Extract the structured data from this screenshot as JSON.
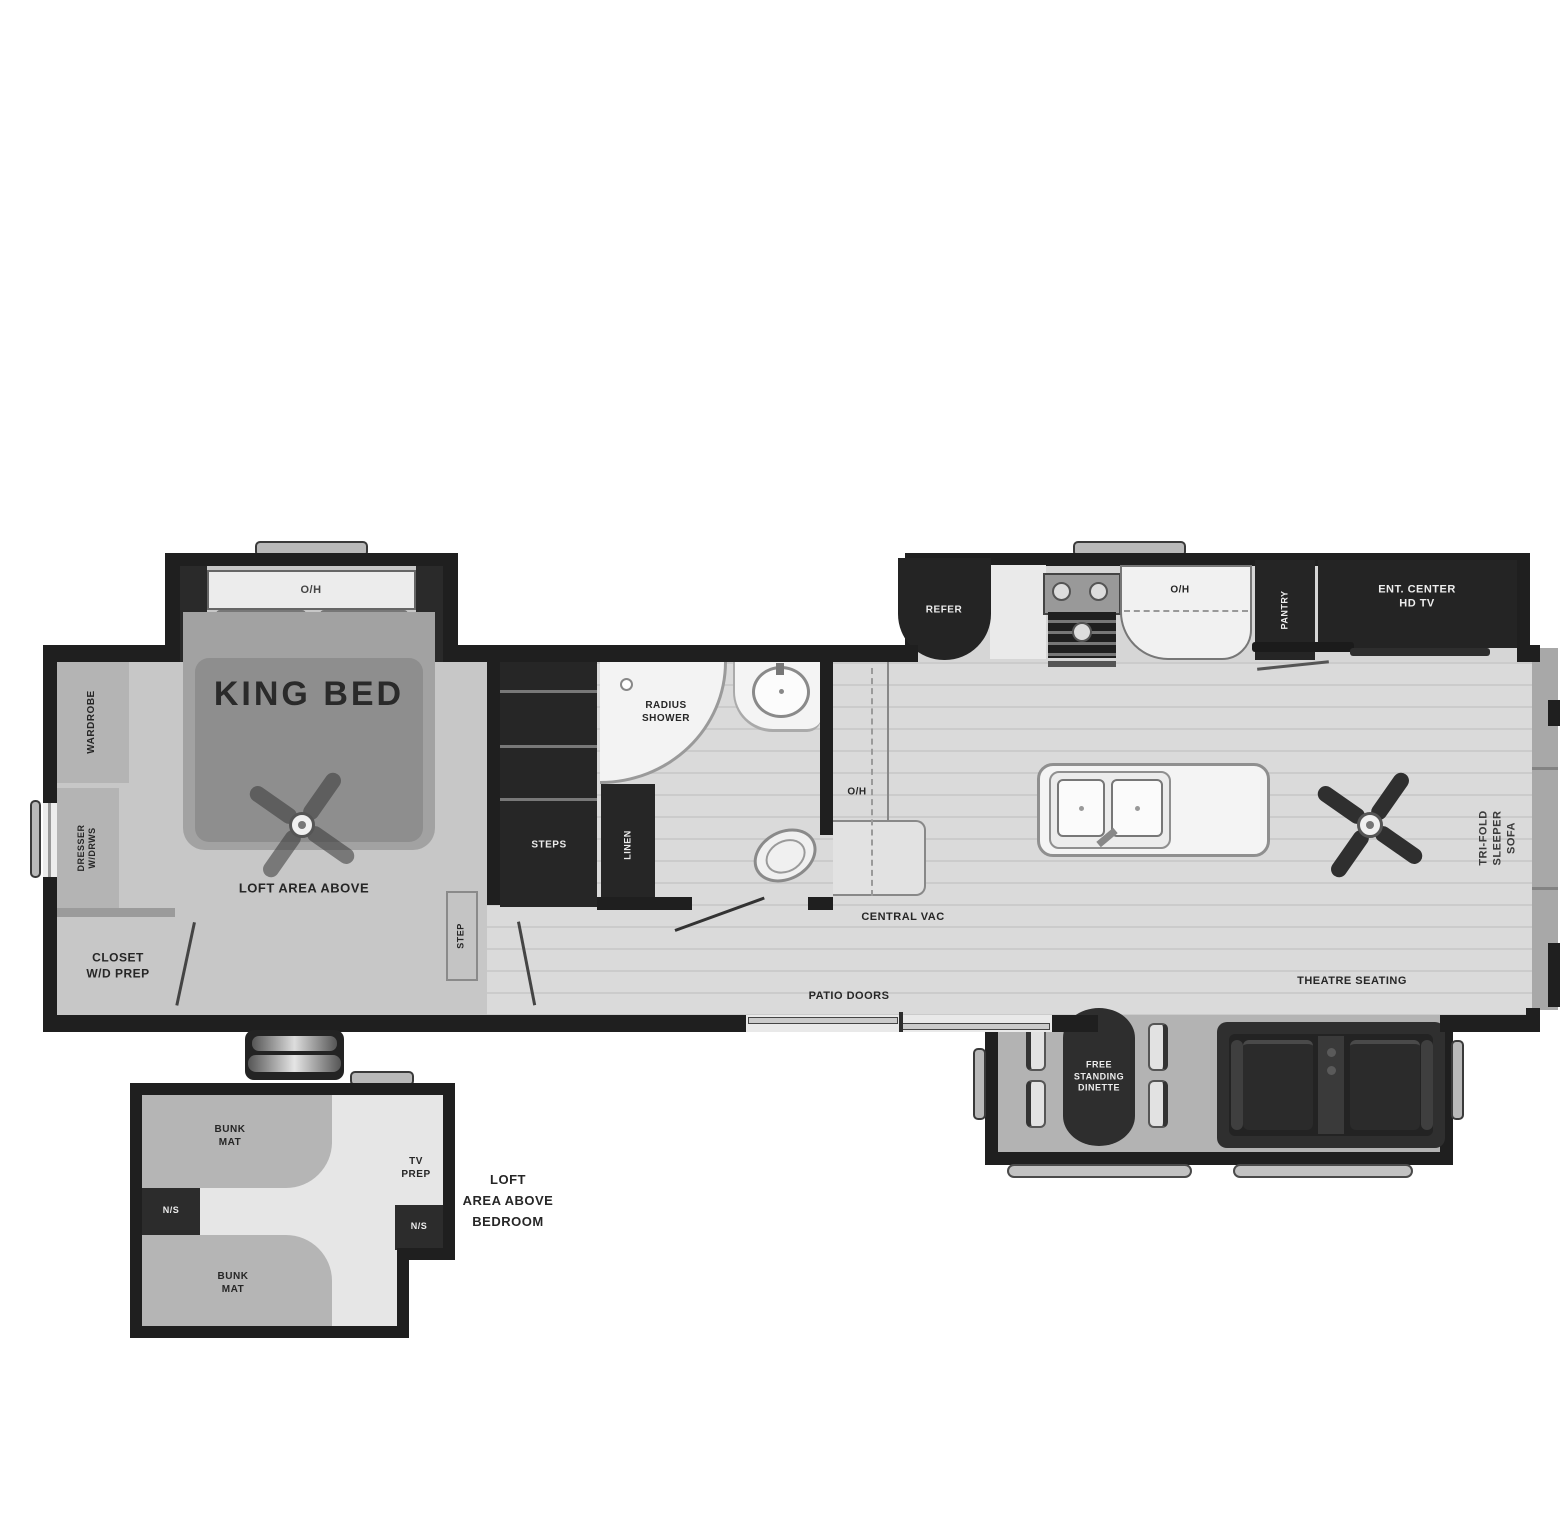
{
  "labels": {
    "bed_oh": "O/H",
    "king_bed": "KING BED",
    "loft_above": "LOFT AREA ABOVE",
    "wardrobe": "WARDROBE",
    "dresser": "DRESSER\nW/DRWS",
    "closet": "CLOSET\nW/D PREP",
    "step": "STEP",
    "steps": "STEPS",
    "linen": "LINEN",
    "radius_shower": "RADIUS\nSHOWER",
    "refer": "REFER",
    "kitchen_oh": "O/H",
    "pantry": "PANTRY",
    "ent_center": "ENT. CENTER\nHD TV",
    "counter_oh": "O/H",
    "central_vac": "CENTRAL VAC",
    "sofa": "TRI-FOLD\nSLEEPER SOFA",
    "theatre": "THEATRE SEATING",
    "patio": "PATIO DOORS",
    "dinette": "FREE\nSTANDING\nDINETTE",
    "bunk_top": "BUNK\nMAT",
    "ns_left": "N/S",
    "bunk_bottom": "BUNK\nMAT",
    "ns_right": "N/S",
    "tv_prep": "TV\nPREP",
    "loft_caption": "LOFT\nAREA ABOVE\nBEDROOM"
  },
  "colors": {
    "wall": "#1f1f1f",
    "wood_floor": "#dadada",
    "bedroom_floor": "#c7c7c7",
    "dark_furniture": "#262626",
    "slide_floor": "#b3b3b3",
    "background": "#ffffff"
  }
}
